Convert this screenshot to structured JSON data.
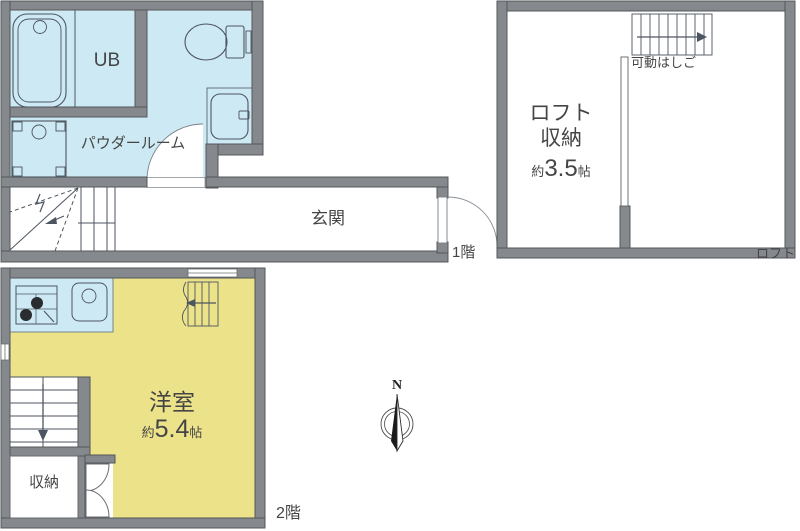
{
  "plan": {
    "floor1": {
      "floor_label": "1階",
      "unit_bath_label": "UB",
      "powder_room_label": "パウダールーム",
      "entrance_label": "玄関",
      "fixtures": [
        "bathtub",
        "toilet",
        "washbasin",
        "washing-machine",
        "winder-staircase",
        "entrance-door"
      ]
    },
    "loft": {
      "floor_label": "ロフト",
      "ladder_label": "可動はしご",
      "room_line1": "ロフト",
      "room_line2": "収納",
      "area_prefix": "約",
      "area_value": "3.5",
      "area_unit": "帖"
    },
    "floor2": {
      "floor_label": "2階",
      "room_label": "洋室",
      "area_prefix": "約",
      "area_value": "5.4",
      "area_unit": "帖",
      "closet_label": "収納",
      "fixtures": [
        "gas-stove",
        "kitchen-sink",
        "staircase-down",
        "loft-ladder",
        "closet-double-door",
        "window"
      ]
    },
    "compass": {
      "north": "N"
    },
    "colors": {
      "wet_area_blue": "#cde9f3",
      "room_yellow": "#ece28a",
      "wall_gray": "#85888c",
      "line_dark": "#4d5560"
    }
  }
}
